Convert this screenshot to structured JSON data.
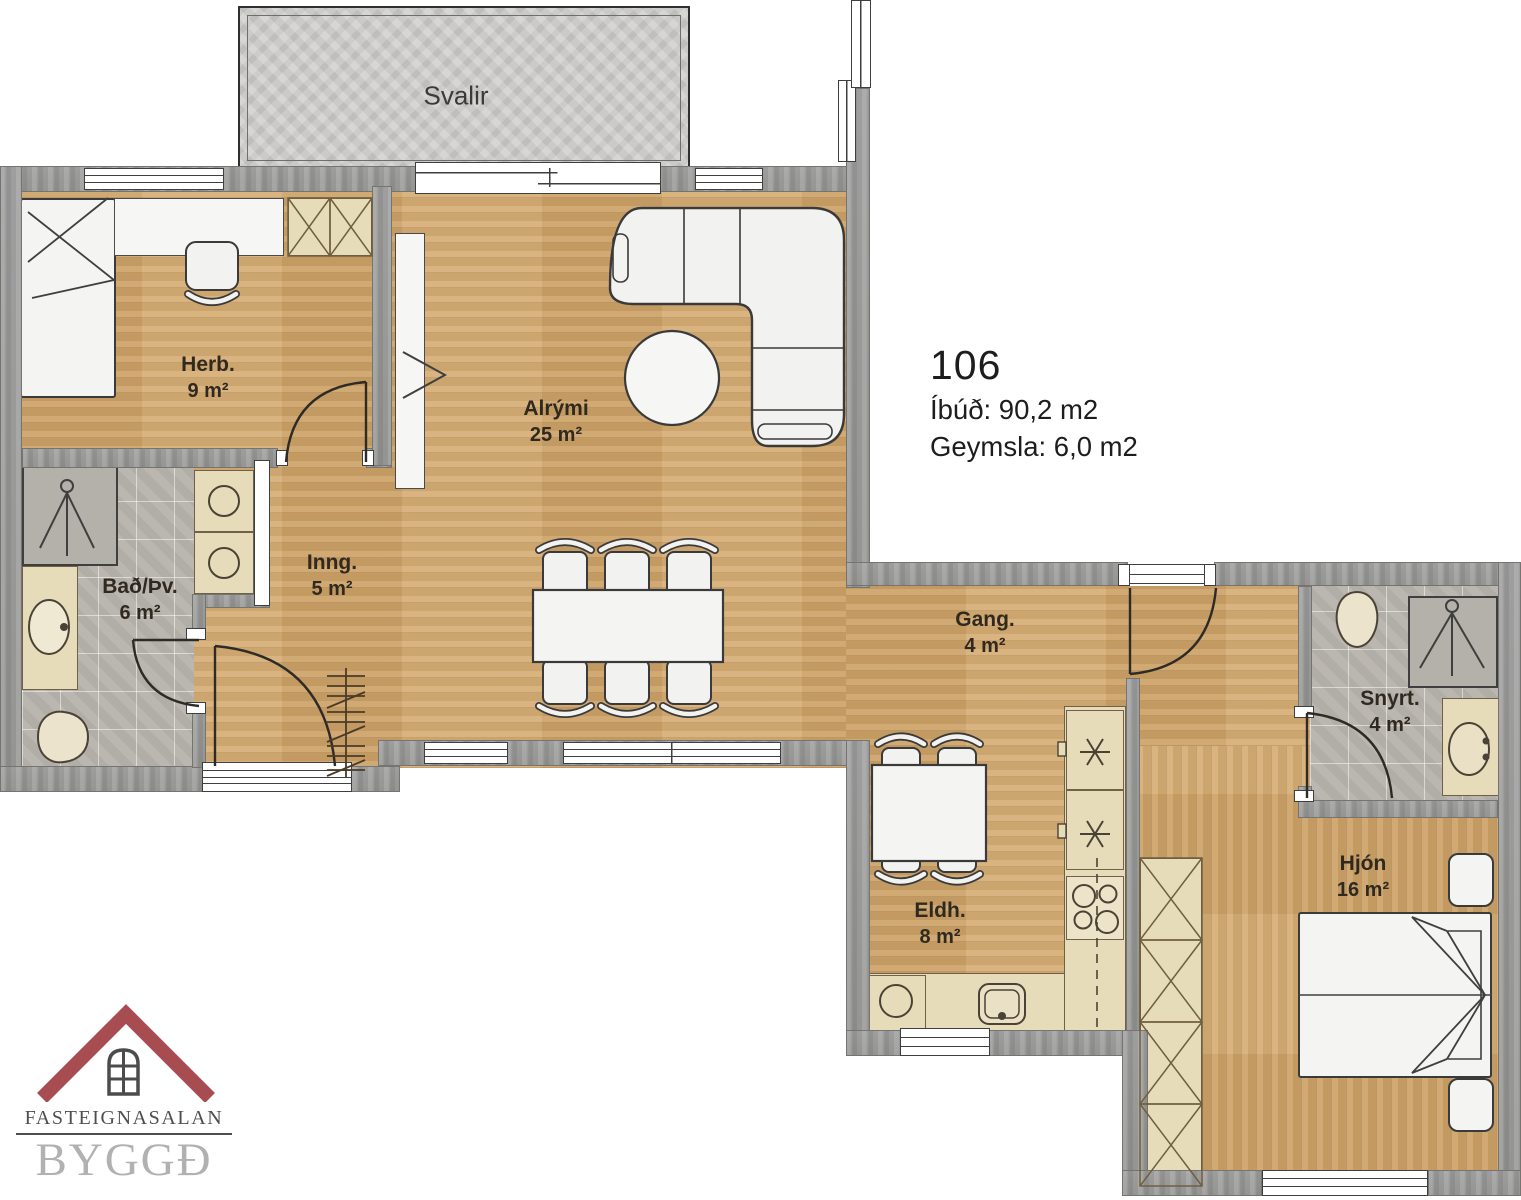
{
  "plan": {
    "unit": {
      "number": "106",
      "line1": "Íbúð: 90,2 m2",
      "line2": "Geymsla: 6,0 m2"
    },
    "rooms": {
      "svalir": {
        "name": "Svalir"
      },
      "herb": {
        "name": "Herb.",
        "area": "9 m²"
      },
      "alrymi": {
        "name": "Alrými",
        "area": "25 m²"
      },
      "inng": {
        "name": "Inng.",
        "area": "5 m²"
      },
      "bad": {
        "name": "Bað/Þv.",
        "area": "6 m²"
      },
      "gang": {
        "name": "Gang.",
        "area": "4 m²"
      },
      "eldh": {
        "name": "Eldh.",
        "area": "8 m²"
      },
      "snyrt": {
        "name": "Snyrt.",
        "area": "4 m²"
      },
      "hjon": {
        "name": "Hjón",
        "area": "16 m²"
      }
    },
    "logo": {
      "agency": "FASTEIGNASALAN",
      "brand": "BYGGÐ"
    },
    "colors": {
      "wood": "#d5a96c",
      "wall_gray": "#9a9a9a",
      "tile_gray": "#b7b3ac",
      "balcony_concrete": "#cbcac8",
      "counter_beige": "#e6dcba",
      "furniture_white": "#f4f4f2",
      "logo_red": "#a74c50",
      "logo_gray": "#b1b1b1",
      "label_text": "#30291f"
    },
    "icons": {
      "shower": "shower-icon",
      "toilet": "toilet-icon",
      "sink": "sink-basin-icon",
      "washer": "washing-machine-icon",
      "stove": "stove-burners-icon",
      "freezer": "frost-star-icon",
      "wardrobe": "wardrobe-x-icon",
      "door": "door-swing-icon",
      "coat_rack": "coat-rack-icon",
      "roof": "roof-house-icon"
    }
  }
}
